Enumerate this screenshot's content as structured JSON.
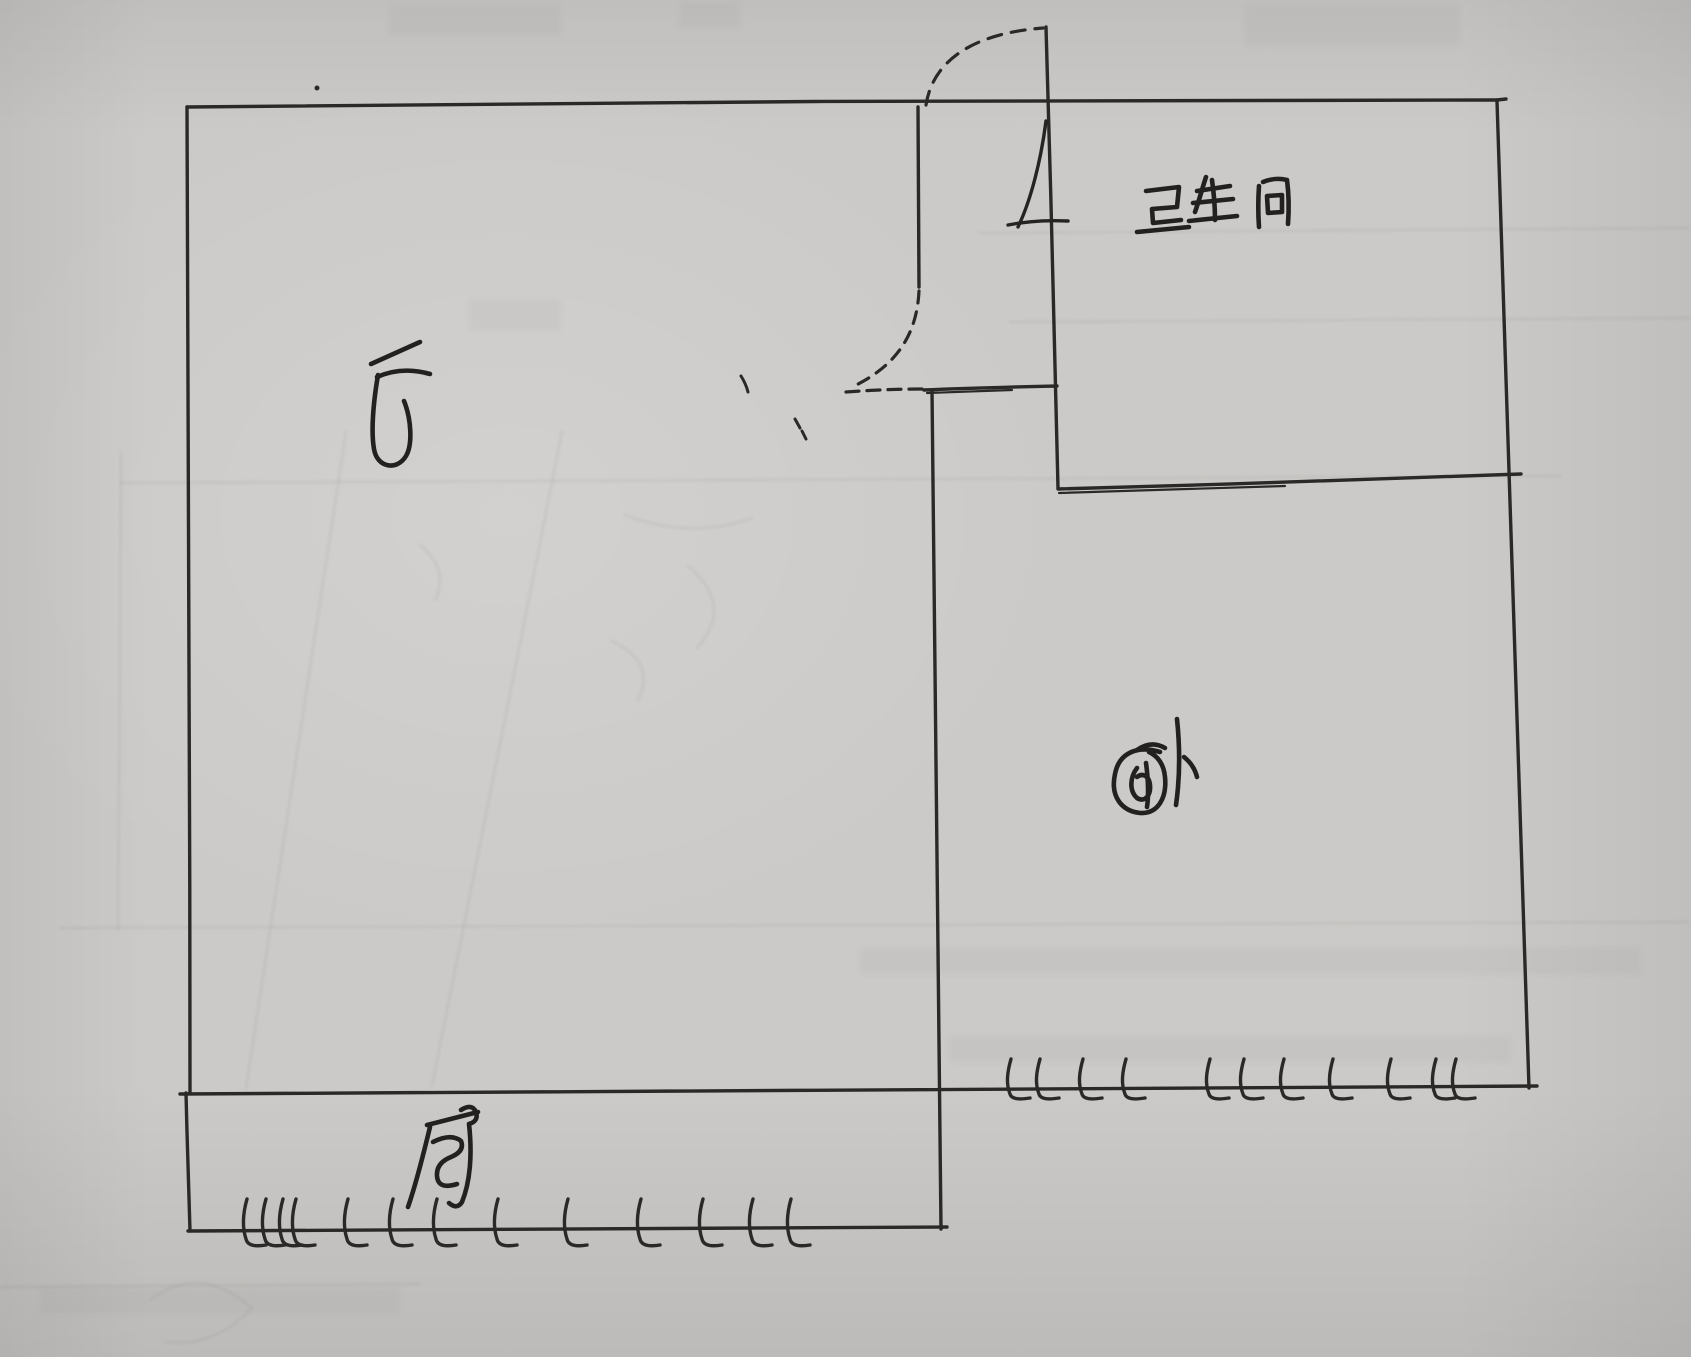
{
  "artifact": {
    "kind": "hand-drawn floor plan sketch",
    "medium": "black ink pen on gray paper, photographed",
    "language": "Chinese"
  },
  "colors": {
    "paper": "#cccac8",
    "ink": "#2b2927",
    "pencil_ghost": "#6b6967"
  },
  "rooms": [
    {
      "id": "hall",
      "label": "厅"
    },
    {
      "id": "bathroom",
      "label": "卫生间"
    },
    {
      "id": "bedroom",
      "label": "卧"
    },
    {
      "id": "kitchen",
      "label": "厨"
    }
  ],
  "symbols": {
    "doors": [
      {
        "id": "entry-door",
        "style": "dashed quarter-circle swing arc above top wall",
        "location": "top wall, center"
      },
      {
        "id": "bathroom-door",
        "style": "solid door-leaf arc with jamb tick",
        "location": "bathroom left wall, below entry"
      },
      {
        "id": "inner-door",
        "style": "dashed quarter-circle swing arc with dashed sill",
        "location": "wall between hall and bedroom corridor"
      }
    ],
    "windows": [
      {
        "id": "bedroom-window",
        "style": "row of hatch tick marks on wall line",
        "location": "bedroom bottom wall"
      },
      {
        "id": "kitchen-window",
        "style": "row of hatch tick marks on wall line",
        "location": "kitchen bottom wall"
      }
    ]
  }
}
